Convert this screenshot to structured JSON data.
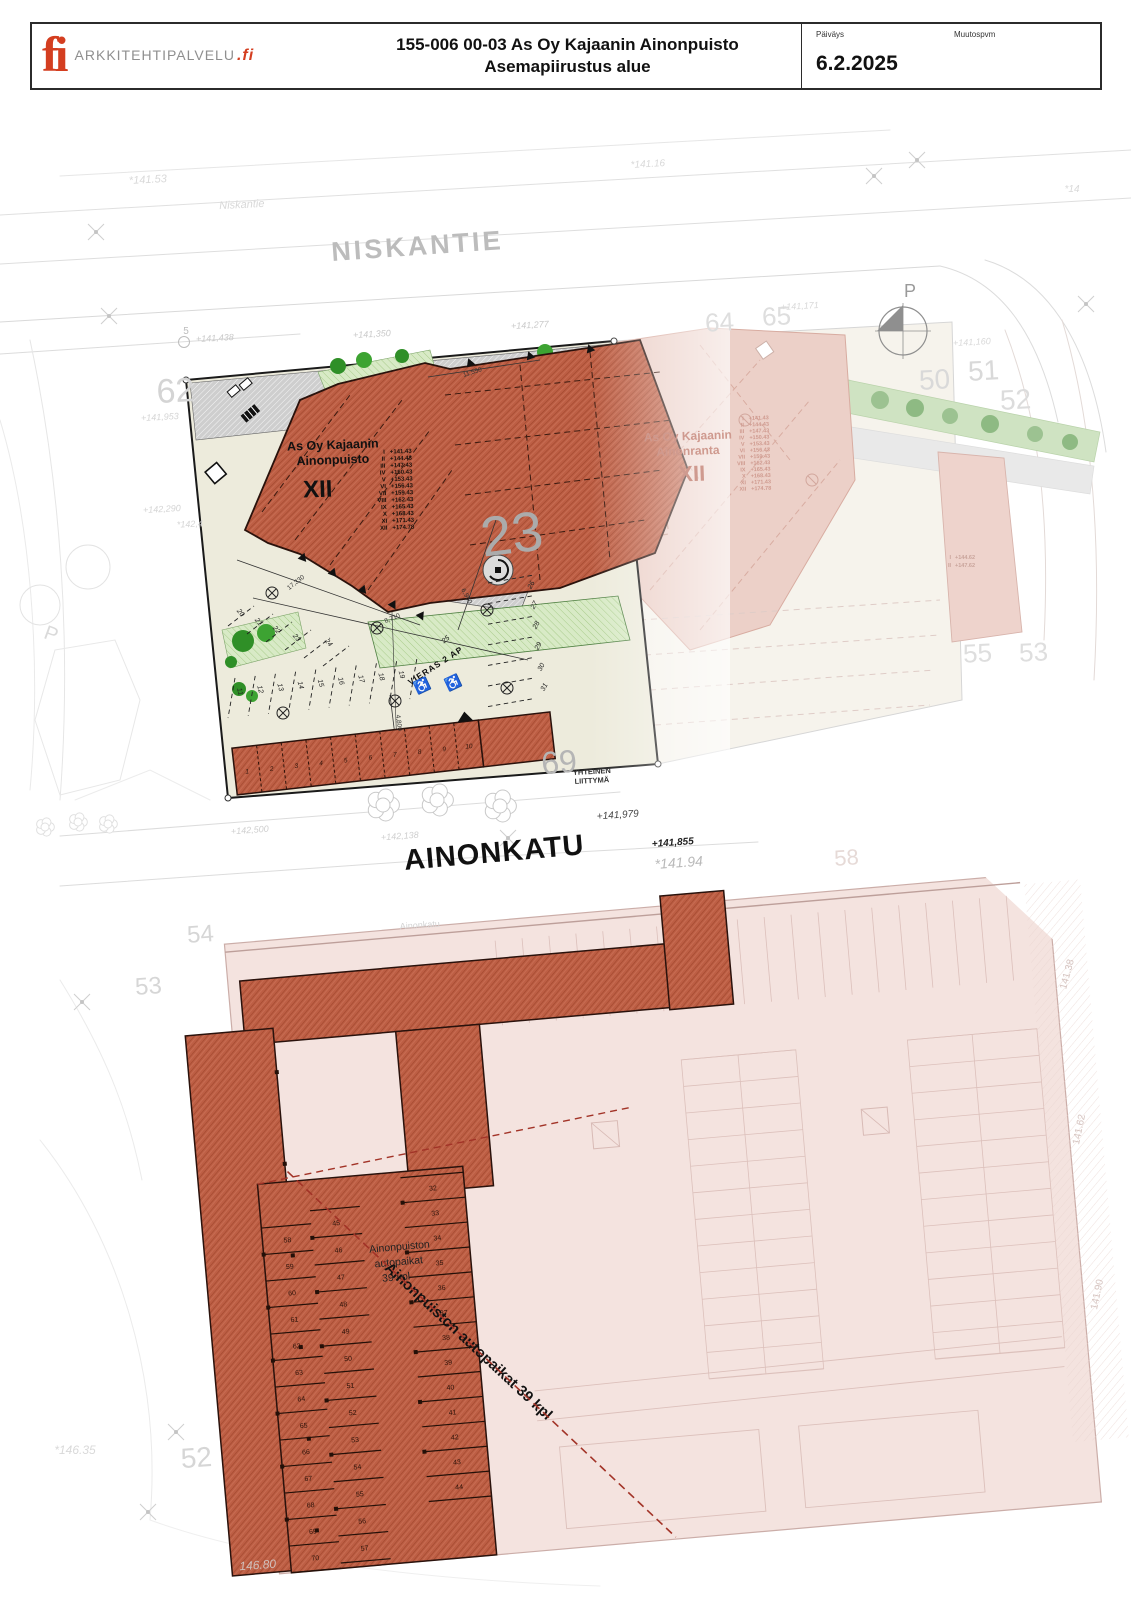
{
  "title_block": {
    "logo_glyph": "fi",
    "logo_text": "ARKKITEHTIPALVELU",
    "logo_suffix": ".fi",
    "title_line1": "155-006 00-03 As Oy Kajaanin Ainonpuisto",
    "title_line2": "Asemapiirustus alue",
    "date_label": "Päiväys",
    "date_value": "6.2.2025",
    "revision_label": "Muutospvm",
    "revision_value": ""
  },
  "streets": {
    "niskantie_major": "NISKANTIE",
    "niskantie_minor": "Niskantie",
    "ainonkatu_major": "AINONKATU",
    "ainonkatu_minor": "Ainonkatu"
  },
  "buildings": {
    "ainonpuisto": {
      "name_line1": "As Oy Kajaanin",
      "name_line2": "Ainonpuisto",
      "storeys": "XII",
      "floors": [
        {
          "level": "I",
          "elev": "+141.43"
        },
        {
          "level": "II",
          "elev": "+144.43"
        },
        {
          "level": "III",
          "elev": "+147.43"
        },
        {
          "level": "IV",
          "elev": "+150.43"
        },
        {
          "level": "V",
          "elev": "+153.43"
        },
        {
          "level": "VI",
          "elev": "+156.43"
        },
        {
          "level": "VII",
          "elev": "+159.43"
        },
        {
          "level": "VIII",
          "elev": "+162.43"
        },
        {
          "level": "IX",
          "elev": "+165.43"
        },
        {
          "level": "X",
          "elev": "+168.43"
        },
        {
          "level": "XI",
          "elev": "+171.43"
        },
        {
          "level": "XII",
          "elev": "+174.78"
        }
      ]
    },
    "ainonranta": {
      "name_line1": "As Oy Kajaanin",
      "name_line2": "Ainonranta",
      "storeys": "XII",
      "floors": [
        {
          "level": "I",
          "elev": "+141.43"
        },
        {
          "level": "II",
          "elev": "+144.43"
        },
        {
          "level": "III",
          "elev": "+147.43"
        },
        {
          "level": "IV",
          "elev": "+150.43"
        },
        {
          "level": "V",
          "elev": "+153.43"
        },
        {
          "level": "VI",
          "elev": "+156.43"
        },
        {
          "level": "VII",
          "elev": "+159.43"
        },
        {
          "level": "VIII",
          "elev": "+162.43"
        },
        {
          "level": "IX",
          "elev": "+165.43"
        },
        {
          "level": "X",
          "elev": "+168.43"
        },
        {
          "level": "XI",
          "elev": "+171.43"
        },
        {
          "level": "XII",
          "elev": "+174.78"
        }
      ]
    },
    "side_building": {
      "floors": [
        {
          "level": "I",
          "elev": "+144.62"
        },
        {
          "level": "II",
          "elev": "+147.62"
        }
      ]
    }
  },
  "parking": {
    "upper": {
      "carport_stalls": [
        "1",
        "2",
        "3",
        "4",
        "5",
        "6",
        "7",
        "8",
        "9",
        "10"
      ],
      "row_a": [
        "20",
        "21",
        "22",
        "23",
        "24"
      ],
      "row_b": [
        "11",
        "12",
        "13",
        "14",
        "15",
        "16",
        "17",
        "18",
        "19"
      ],
      "row_c": [
        "25",
        "26",
        "27",
        "28",
        "29",
        "30",
        "31"
      ],
      "visitor_label": "VIERAS 2 AP"
    },
    "lower": {
      "label_line1": "Ainonpuiston",
      "label_line2": "autopaikat",
      "label_line3": "39 kpl",
      "diagonal_label": "Ainonpuiston autopaikat 39 kpl",
      "col_left": [
        "58",
        "59",
        "60",
        "61",
        "62",
        "63",
        "64",
        "65",
        "66",
        "67",
        "68",
        "69",
        "70"
      ],
      "col_mid": [
        "45",
        "46",
        "47",
        "48",
        "49",
        "50",
        "51",
        "52",
        "53",
        "54",
        "55",
        "56",
        "57"
      ],
      "col_right": [
        "32",
        "33",
        "34",
        "35",
        "36",
        "37",
        "38",
        "39",
        "40",
        "41",
        "42",
        "43",
        "44"
      ]
    }
  },
  "annotations": {
    "north_label": "P",
    "neighbor_p": "P",
    "yhteinen_line1": "YHTEINEN",
    "yhteinen_line2": "LIITTYMÄ"
  },
  "block_numbers": {
    "b5": "5",
    "b62": "62",
    "b23": "23",
    "b69": "69",
    "b64": "64",
    "b65": "65",
    "b50": "50",
    "b51": "51",
    "b52r": "52",
    "b55": "55",
    "b53r": "53",
    "b54": "54",
    "b53l": "53",
    "b52b": "52",
    "b58f": "58"
  },
  "spot_elevations": {
    "e14153": "*141.53",
    "e141438": "+141,438",
    "e141350": "+141,350",
    "e141277": "+141,277",
    "e141171": "+141,171",
    "e141160": "+141,160",
    "e14116": "*141.16",
    "e14": "*14",
    "e141953": "+141,953",
    "e142290": "+142,290",
    "e1424": "*142,4",
    "e142500": "+142,500",
    "e142138": "+142,138",
    "e141979": "+141,979",
    "e141855": "+141,855",
    "e14194": "*141.94",
    "e14635": "*146.35",
    "e14680": "146.80",
    "e14138": "141.38",
    "e14162": "141.62",
    "e14190": "141.90"
  },
  "dimensions": {
    "dim1": "17,330",
    "dim2": "8,710",
    "dim3": "6,950",
    "dim4": "4,800",
    "dim5": "11,550"
  }
}
